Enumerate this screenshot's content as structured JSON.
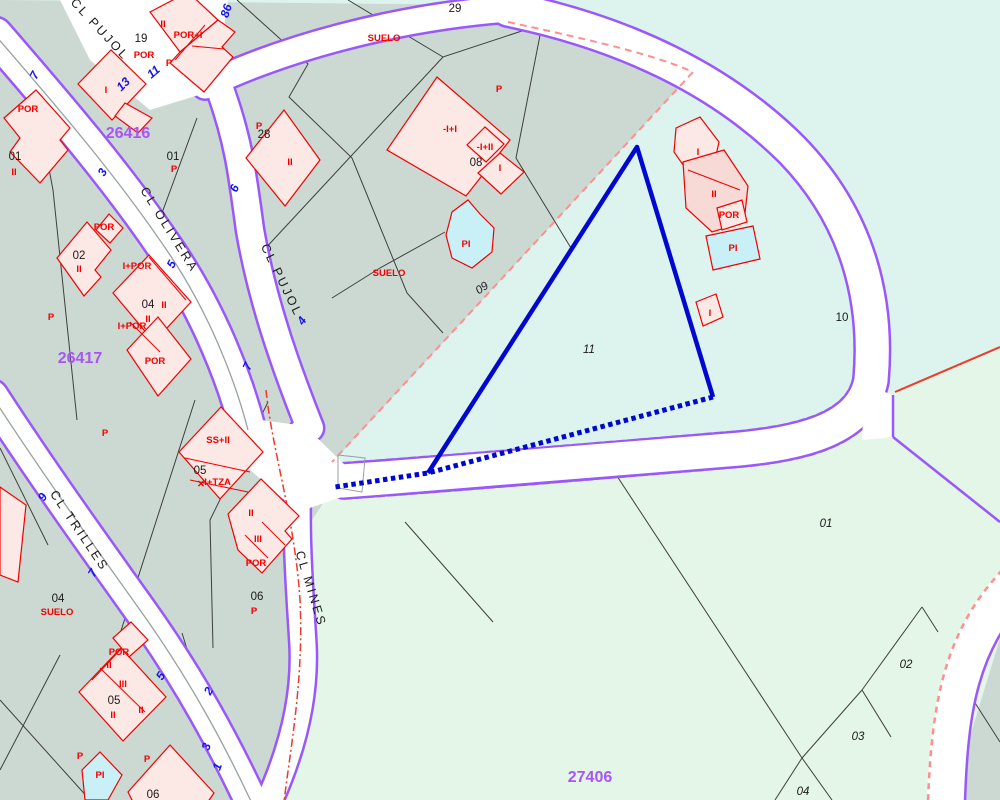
{
  "map": {
    "title": "cadastral-map",
    "palette": {
      "mint": "#ddf3ed",
      "sage": "#cbd9d2",
      "pale": "#e3f6e7",
      "road_fill": "#ffffff",
      "road_edge": "#9a57fa",
      "parcel_line": "#3f3f3f",
      "building_fill": "#fce9e6",
      "building_dark": "#f7d9d6",
      "building_stroke": "#f20000",
      "pool_fill": "#c9eff7",
      "highlight": "#0008d0",
      "boundary_dash": "#ff8f8f",
      "boundary_red": "#f03828",
      "centerline": "#9aa0a0",
      "zone_label": "#a855f7",
      "street_number": "#1414e8"
    },
    "regions": [
      {
        "name": "zone-26416-sage",
        "fill": "sage",
        "points": "0,0 500,5 695,70 330,465 318,560 318,700 308,800 0,800"
      },
      {
        "name": "zone-27406-pale-green",
        "fill": "pale",
        "points": "345,470 870,425 892,437 892,393 1000,348 1000,802 925,802 262,800 300,640 312,520"
      },
      {
        "name": "east-sage-corner",
        "fill": "sage",
        "points": "1008,612 1000,802 950,802"
      }
    ],
    "parcel_lines": [
      "237,0 308,64 289,97 352,158 407,293 443,333",
      "443,57 262,252",
      "348,0 443,57 540,25",
      "542,25 516,158 571,248",
      "445,232 380,268 332,298",
      "35,95 53,190 77,420",
      "197,118 152,240",
      "233,393 196,318",
      "195,400 118,640",
      "268,402 210,520 213,648",
      "182,633 233,797",
      "0,700 90,800",
      "60,655 0,770",
      "0,448 48,545",
      "570,452 613,470 802,758 832,800",
      "802,758 775,800",
      "922,607 862,690",
      "922,607 938,632",
      "862,690 891,737",
      "862,690 802,758",
      "970,695 1000,742",
      "405,522 493,622"
    ],
    "roads": [
      {
        "name": "cl-olivera",
        "d": "M-5,35 C60,110 120,180 170,255 C210,315 235,380 248,430",
        "w": 34,
        "edge": "solid"
      },
      {
        "name": "cl-trilles",
        "d": "M-8,396 C40,470 90,540 140,610 C190,680 225,745 256,812",
        "w": 31,
        "edge": "solid"
      },
      {
        "name": "cl-pujol",
        "d": "M195,-10 C205,35 210,65 221,92 C238,140 242,170 250,230 C262,300 285,365 310,428",
        "w": 26,
        "edge": "solid"
      },
      {
        "name": "top-connector",
        "d": "M205,86 C280,50 390,18 508,9",
        "w": 25,
        "edge": "solid"
      },
      {
        "name": "ring-road-curve",
        "d": "M508,9 C625,33 722,80 792,150 C858,218 878,300 871,380",
        "w": 33,
        "edge": "solid"
      },
      {
        "name": "ring-road-south",
        "d": "M871,380 C862,430 800,443 740,449 C620,459 480,471 342,481",
        "w": 33,
        "edge": "dashed"
      },
      {
        "name": "cl-mines",
        "d": "M302,432 C292,510 300,590 303,645 C306,705 288,762 264,812",
        "w": 25,
        "edge": "solid"
      },
      {
        "name": "southeast-road",
        "d": "M1020,578 C962,638 950,700 946,802",
        "w": 38,
        "edge": "none"
      }
    ],
    "junctions": [
      "232,416 305,426 348,468 342,497 298,512 248,468",
      "60,0 228,0 215,90 150,110 90,60",
      "865,385 893,395 893,437 862,440"
    ],
    "edge_overlays": [
      {
        "d": "M1030,595 C978,650 968,710 965,802",
        "color": "road_edge",
        "w": 2.5
      },
      {
        "d": "M1010,562 C946,626 932,695 928,802",
        "color": "boundary_dash",
        "w": 2.5,
        "dash": "6 5"
      },
      {
        "d": "M893,395 L893,437",
        "color": "road_edge",
        "w": 2.5
      },
      {
        "d": "M893,437 L1000,522",
        "color": "road_edge",
        "w": 2.5
      },
      {
        "d": "M895,392 L1000,347",
        "color": "boundary_red",
        "w": 2
      },
      {
        "d": "M508,22 C600,42 655,55 693,72 L332,462",
        "color": "boundary_dash",
        "w": 2,
        "dash": "7 5"
      },
      {
        "d": "M266,390 C272,450 295,520 300,600 C304,680 290,750 284,802",
        "color": "boundary_red",
        "w": 1.5,
        "dash": "8 3 2 3"
      },
      {
        "d": "M-5,35 C60,110 120,180 170,255 C210,315 235,380 248,430",
        "color": "centerline",
        "w": 1.3
      },
      {
        "d": "M-8,396 C40,470 90,540 140,610 C190,680 225,745 256,812",
        "color": "centerline",
        "w": 1.3
      },
      {
        "d": "M338,455 L365,458 L362,492 L338,488 Z",
        "color": "centerline",
        "w": 1
      }
    ],
    "buildings": [
      {
        "p": "150,12 188,-8 218,20 180,52"
      },
      {
        "p": "180,52 218,20 235,32 222,47 233,57 204,92 170,63"
      },
      {
        "p": "78,84 111,50 146,84 112,120"
      },
      {
        "p": "125,103 152,118 138,133 115,116"
      },
      {
        "p": "4,118 36,90 70,128 60,140 68,150 40,183 10,152 20,138"
      },
      {
        "p": "246,158 284,110 320,160 285,206"
      },
      {
        "p": "96,230 109,214 123,228 110,243"
      },
      {
        "p": "57,258 87,222 111,250 95,270 101,277 84,296"
      },
      {
        "p": "113,293 149,255 191,302 154,342"
      },
      {
        "p": "127,350 158,317 191,359 158,396"
      },
      {
        "p": "179,452 221,407 263,452 220,499"
      },
      {
        "p": "228,514 261,479 299,516 285,531 292,539 262,573 238,550"
      },
      {
        "p": "79,692 121,648 166,697 123,741"
      },
      {
        "p": "113,638 131,622 148,640 129,657"
      },
      {
        "p": "128,792 170,745 214,793 205,806 135,806"
      },
      {
        "p": "0,487 26,505 18,582 0,575"
      },
      {
        "p": "437,77 510,140 466,196 387,150"
      },
      {
        "p": "485,127 504,144 486,162 467,145"
      },
      {
        "p": "500,153 524,172 501,194 478,173"
      },
      {
        "p": "676,128 700,117 719,142 713,169 688,172 674,152"
      },
      {
        "p": "683,162 724,150 748,186 744,222 712,232 686,208",
        "dark": true
      },
      {
        "p": "717,208 742,200 747,222 722,230"
      },
      {
        "p": "696,302 716,294 723,317 703,326"
      }
    ],
    "building_lines": [
      "175,60 205,25",
      "192,46 224,49",
      "149,257 186,300",
      "130,322 160,352",
      "185,458 250,472",
      "190,480 248,492",
      "262,522 285,545",
      "245,535 268,558",
      "100,668 145,712",
      "121,649 92,680",
      "688,170 740,190"
    ],
    "pools": [
      "452,212 468,200 480,214 494,228 492,252 472,268 452,258 446,235",
      "706,236 753,226 760,259 713,270",
      "82,770 100,752 122,775 108,800 85,800"
    ],
    "highlight_parcel": {
      "solid": "M428,473 L637,147 L713,397",
      "dotted": "M713,397 L428,473 L335,487"
    },
    "labels": {
      "zones": [
        {
          "t": "26416",
          "x": 128,
          "y": 138
        },
        {
          "t": "26417",
          "x": 80,
          "y": 363
        },
        {
          "t": "27406",
          "x": 590,
          "y": 782
        }
      ],
      "streets": [
        {
          "t": "CL PUJOL",
          "x": 97,
          "y": 32,
          "r": 47
        },
        {
          "t": "CL PUJOL",
          "x": 278,
          "y": 282,
          "r": 64
        },
        {
          "t": "CL OLIVERA",
          "x": 166,
          "y": 232,
          "r": 58
        },
        {
          "t": "CL TRILLES",
          "x": 76,
          "y": 533,
          "r": 56
        },
        {
          "t": "CL MINES",
          "x": 307,
          "y": 590,
          "r": 73
        }
      ],
      "parcels": [
        {
          "t": "19",
          "x": 141,
          "y": 42
        },
        {
          "t": "28",
          "x": 264,
          "y": 138
        },
        {
          "t": "01",
          "x": 15,
          "y": 160
        },
        {
          "t": "01",
          "x": 173,
          "y": 160
        },
        {
          "t": "02",
          "x": 79,
          "y": 259
        },
        {
          "t": "04",
          "x": 148,
          "y": 308
        },
        {
          "t": "29",
          "x": 455,
          "y": 12
        },
        {
          "t": "08",
          "x": 476,
          "y": 166
        },
        {
          "t": "09",
          "x": 484,
          "y": 291,
          "r": -35,
          "i": true
        },
        {
          "t": "05",
          "x": 200,
          "y": 474
        },
        {
          "t": "06",
          "x": 257,
          "y": 600
        },
        {
          "t": "04",
          "x": 58,
          "y": 602
        },
        {
          "t": "05",
          "x": 114,
          "y": 704
        },
        {
          "t": "06",
          "x": 153,
          "y": 798
        },
        {
          "t": "10",
          "x": 842,
          "y": 321
        },
        {
          "t": "11",
          "x": 589,
          "y": 353,
          "i": true
        },
        {
          "t": "01",
          "x": 826,
          "y": 527,
          "i": true
        },
        {
          "t": "02",
          "x": 906,
          "y": 668,
          "i": true
        },
        {
          "t": "03",
          "x": 858,
          "y": 740,
          "i": true
        },
        {
          "t": "04",
          "x": 803,
          "y": 795,
          "i": true
        }
      ],
      "annotations": [
        {
          "t": "POR",
          "x": 28,
          "y": 112
        },
        {
          "t": "II",
          "x": 14,
          "y": 175
        },
        {
          "t": "II",
          "x": 163,
          "y": 27
        },
        {
          "t": "POR",
          "x": 144,
          "y": 58
        },
        {
          "t": "POR+I",
          "x": 188,
          "y": 38
        },
        {
          "t": "P",
          "x": 169,
          "y": 66
        },
        {
          "t": "I",
          "x": 106,
          "y": 93
        },
        {
          "t": "P",
          "x": 259,
          "y": 129
        },
        {
          "t": "II",
          "x": 290,
          "y": 165
        },
        {
          "t": "P",
          "x": 174,
          "y": 172
        },
        {
          "t": "POR",
          "x": 104,
          "y": 230
        },
        {
          "t": "II",
          "x": 79,
          "y": 272
        },
        {
          "t": "P",
          "x": 51,
          "y": 320
        },
        {
          "t": "I+POR",
          "x": 137,
          "y": 269
        },
        {
          "t": "II",
          "x": 164,
          "y": 308
        },
        {
          "t": "II",
          "x": 148,
          "y": 322
        },
        {
          "t": "I+POR",
          "x": 132,
          "y": 329
        },
        {
          "t": "POR",
          "x": 155,
          "y": 364
        },
        {
          "t": "SUELO",
          "x": 384,
          "y": 41
        },
        {
          "t": "P",
          "x": 499,
          "y": 92
        },
        {
          "t": "-I+I",
          "x": 450,
          "y": 132
        },
        {
          "t": "-I+II",
          "x": 485,
          "y": 150
        },
        {
          "t": "I",
          "x": 500,
          "y": 171
        },
        {
          "t": "PI",
          "x": 466,
          "y": 247
        },
        {
          "t": "SUELO",
          "x": 389,
          "y": 276
        },
        {
          "t": "P",
          "x": 105,
          "y": 436
        },
        {
          "t": "SS+II",
          "x": 218,
          "y": 443
        },
        {
          "t": "-I+TZA",
          "x": 216,
          "y": 485
        },
        {
          "t": "✕",
          "x": 201,
          "y": 487
        },
        {
          "t": "II",
          "x": 251,
          "y": 516
        },
        {
          "t": "III",
          "x": 258,
          "y": 542
        },
        {
          "t": "POR",
          "x": 256,
          "y": 566
        },
        {
          "t": "P",
          "x": 254,
          "y": 614
        },
        {
          "t": "SUELO",
          "x": 57,
          "y": 615
        },
        {
          "t": "POR",
          "x": 119,
          "y": 655
        },
        {
          "t": "II",
          "x": 109,
          "y": 668
        },
        {
          "t": "III",
          "x": 123,
          "y": 687
        },
        {
          "t": "II",
          "x": 113,
          "y": 718
        },
        {
          "t": "II",
          "x": 141,
          "y": 713
        },
        {
          "t": "P",
          "x": 80,
          "y": 759
        },
        {
          "t": "PI",
          "x": 100,
          "y": 778
        },
        {
          "t": "P",
          "x": 147,
          "y": 762
        },
        {
          "t": "I",
          "x": 698,
          "y": 155
        },
        {
          "t": "II",
          "x": 714,
          "y": 197
        },
        {
          "t": "POR",
          "x": 729,
          "y": 218
        },
        {
          "t": "PI",
          "x": 733,
          "y": 251
        },
        {
          "t": "I",
          "x": 710,
          "y": 316
        }
      ],
      "street_numbers": [
        {
          "t": "7",
          "x": 38,
          "y": 77,
          "r": -62
        },
        {
          "t": "3",
          "x": 106,
          "y": 174,
          "r": -62
        },
        {
          "t": "13",
          "x": 126,
          "y": 87,
          "r": -45
        },
        {
          "t": "11",
          "x": 156,
          "y": 75,
          "r": -40
        },
        {
          "t": "86",
          "x": 230,
          "y": 12,
          "r": -72
        },
        {
          "t": "6",
          "x": 238,
          "y": 190,
          "r": -65
        },
        {
          "t": "5",
          "x": 175,
          "y": 266,
          "r": -62
        },
        {
          "t": "7",
          "x": 251,
          "y": 368,
          "r": -65
        },
        {
          "t": "4",
          "x": 305,
          "y": 323,
          "r": -55
        },
        {
          "t": "9",
          "x": 46,
          "y": 499,
          "r": -60
        },
        {
          "t": "7",
          "x": 96,
          "y": 575,
          "r": -58
        },
        {
          "t": "5",
          "x": 164,
          "y": 678,
          "r": -58
        },
        {
          "t": "2",
          "x": 212,
          "y": 693,
          "r": -60
        },
        {
          "t": "3",
          "x": 210,
          "y": 748,
          "r": -70
        },
        {
          "t": "1",
          "x": 221,
          "y": 768,
          "r": -70
        }
      ]
    }
  }
}
